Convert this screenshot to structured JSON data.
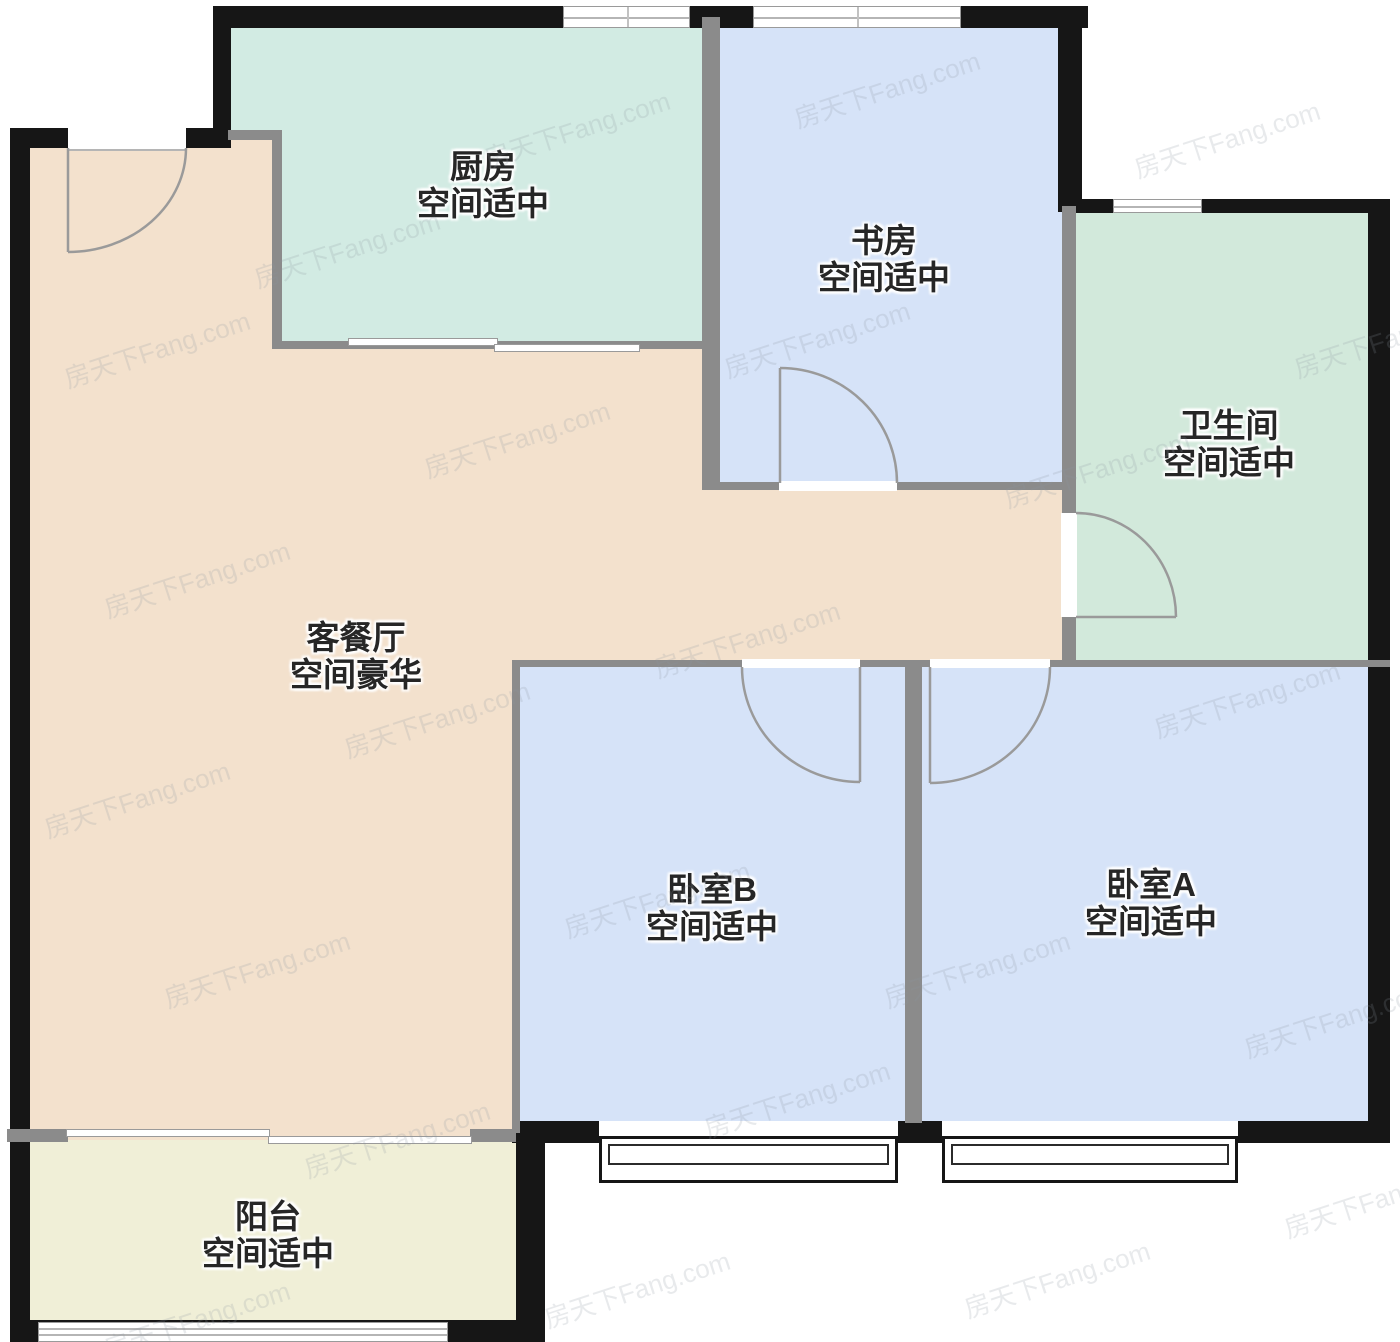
{
  "plan": {
    "watermark_text": "房天下Fang.com",
    "colors": {
      "wall_exterior": "#161616",
      "wall_interior": "#8b8b8b",
      "door_line": "#9a9a9a",
      "kitchen": "#d2ebe3",
      "study": "#d6e3f8",
      "bathroom": "#d2e9db",
      "living_dining": "#f3e1cd",
      "bedroom": "#d6e3f8",
      "balcony": "#f0efd7"
    },
    "rooms": [
      {
        "id": "kitchen",
        "name": "厨房",
        "size_label": "空间适中",
        "color": "#d2ebe3"
      },
      {
        "id": "study",
        "name": "书房",
        "size_label": "空间适中",
        "color": "#d6e3f8"
      },
      {
        "id": "bathroom",
        "name": "卫生间",
        "size_label": "空间适中",
        "color": "#d2e9db"
      },
      {
        "id": "living_dining",
        "name": "客餐厅",
        "size_label": "空间豪华",
        "color": "#f3e1cd"
      },
      {
        "id": "bedroom_b",
        "name": "卧室B",
        "size_label": "空间适中",
        "color": "#d6e3f8"
      },
      {
        "id": "bedroom_a",
        "name": "卧室A",
        "size_label": "空间适中",
        "color": "#d6e3f8"
      },
      {
        "id": "balcony",
        "name": "阳台",
        "size_label": "空间适中",
        "color": "#f0efd7"
      }
    ]
  }
}
